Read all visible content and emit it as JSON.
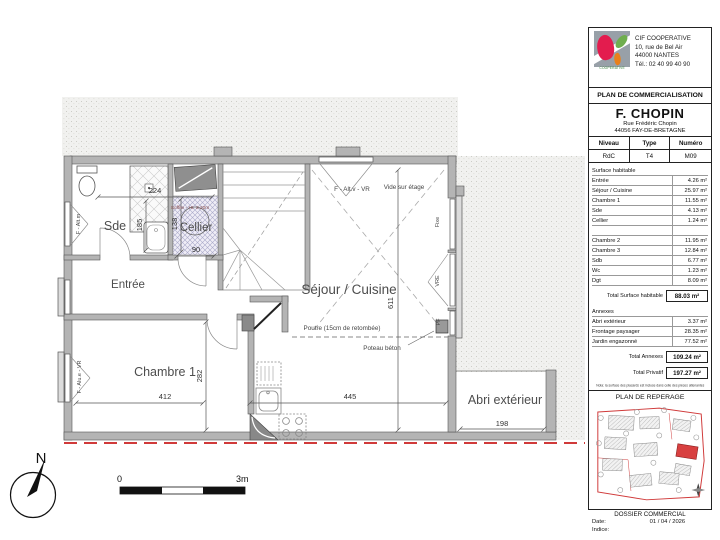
{
  "plan": {
    "rooms": {
      "sde": "Sde",
      "cellier": "Cellier",
      "entree": "Entrée",
      "sejour": "Séjour / Cuisine",
      "chambre1": "Chambre 1",
      "abri": "Abri extérieur"
    },
    "annotations": {
      "vide_sur_etage": "Vide sur étage",
      "window_top": "F - Alt.v - VR",
      "window_sde": "F - Alt.m",
      "window_chambre": "F - Alu.e - VR",
      "fixe": "Fixe",
      "vre": "VRE",
      "pf": "PF",
      "soffite": "Soffite - Ht. 2.20m",
      "poutre": "Poutre (15cm de retombée)",
      "poteau": "Poteau béton"
    },
    "dimensions": {
      "sde_width": "224",
      "sde_depth": "185",
      "cellier_height": "138",
      "cellier_width": "90",
      "chambre1_width": "412",
      "chambre1_depth": "282",
      "sejour_width": "445",
      "sejour_depth": "611",
      "abri_width": "198"
    },
    "north_label": "N",
    "scale_bar": {
      "start": "0",
      "end": "3m"
    }
  },
  "panel": {
    "company": {
      "name": "CIF COOPERATIVE",
      "address_line1": "10, rue de Bel Air",
      "address_line2": "44000 NANTES",
      "phone": "Tél.: 02 40 99 40 90",
      "logo_caption": "COOPÉRATIVE"
    },
    "document_title": "PLAN DE COMMERCIALISATION",
    "project": {
      "name": "F. CHOPIN",
      "address_line1": "Rue Frédéric Chopin",
      "address_line2": "44056 FAY-DE-BRETAGNE"
    },
    "unit": {
      "headers": [
        "Niveau",
        "Type",
        "Numéro"
      ],
      "values": [
        "RdC",
        "T4",
        "M09"
      ]
    },
    "surfaces": {
      "title": "Surface habitable",
      "rows": [
        {
          "label": "Entrée",
          "value": "4.26 m²"
        },
        {
          "label": "Séjour / Cuisine",
          "value": "25.97 m²"
        },
        {
          "label": "Chambre 1",
          "value": "11.55 m²"
        },
        {
          "label": "Sde",
          "value": "4.13 m²"
        },
        {
          "label": "Cellier",
          "value": "1.24 m²"
        }
      ],
      "rows2": [
        {
          "label": "Chambre 2",
          "value": "11.95 m²"
        },
        {
          "label": "Chambre 3",
          "value": "12.84 m²"
        },
        {
          "label": "Sdb",
          "value": "6.77 m²"
        },
        {
          "label": "Wc",
          "value": "1.23 m²"
        },
        {
          "label": "Dgt",
          "value": "8.09 m²"
        }
      ],
      "total_label": "Total Surface habitable",
      "total_value": "88.03 m²"
    },
    "annexes": {
      "title": "Annexes",
      "rows": [
        {
          "label": "Abri extérieur",
          "value": "3.37 m²"
        },
        {
          "label": "Frontage paysager",
          "value": "28.35 m²"
        },
        {
          "label": "Jardin engazonné",
          "value": "77.52 m²"
        }
      ],
      "total_label": "Total Annexes",
      "total_value": "109.24 m²",
      "privatif_label": "Total Privatif",
      "privatif_value": "197.27 m²"
    },
    "note": "Nota: la surface des placards est incluse dans celle des pièces attenantes",
    "reperage_title": "PLAN DE REPERAGE",
    "dossier": {
      "title": "DOSSIER COMMERCIAL",
      "date_label": "Date:",
      "date_value": "01 / 04 / 2026",
      "indice_label": "Indice:"
    }
  },
  "colors": {
    "boundary_red": "#d03a3a",
    "wall_gray": "#b4b4b4",
    "logo_red": "#e31c4e",
    "logo_green": "#6fae4e"
  }
}
